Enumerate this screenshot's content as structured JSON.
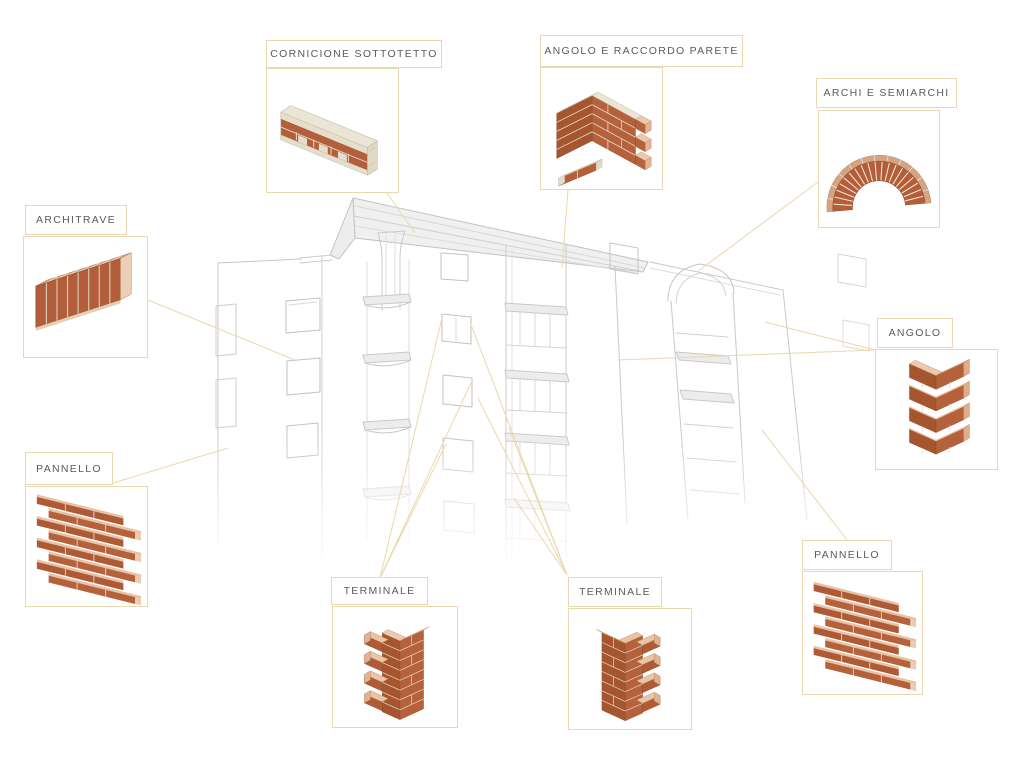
{
  "diagram": {
    "type": "brick-product-callout-diagram",
    "language": "it",
    "components": [
      {
        "id": "cornicione-sottotetto",
        "label": "CORNICIONE SOTTOTETTO"
      },
      {
        "id": "angolo-e-raccordo-parete",
        "label": "ANGOLO E RACCORDO PARETE"
      },
      {
        "id": "archi-e-semiarchi",
        "label": "ARCHI E SEMIARCHI"
      },
      {
        "id": "architrave",
        "label": "ARCHITRAVE"
      },
      {
        "id": "pannello-sinistra",
        "label": "PANNELLO"
      },
      {
        "id": "angolo",
        "label": "ANGOLO"
      },
      {
        "id": "pannello-destra",
        "label": "PANNELLO"
      },
      {
        "id": "terminale-sinistra",
        "label": "TERMINALE"
      },
      {
        "id": "terminale-destra",
        "label": "TERMINALE"
      }
    ],
    "colors": {
      "background": "#ffffff",
      "box_border": "#ead8b2",
      "callout_line": "#ecd7ab",
      "label_text": "#5a5b5d",
      "brick_front": "#b5613c",
      "brick_front_shadow": "#a6562f",
      "brick_top_pink": "#e9c2a4",
      "brick_end_pink": "#ecccb1",
      "stone_cream": "#ece5d6",
      "arch_band": "#d6a483",
      "sketch_line": "#c8c8c8"
    }
  }
}
